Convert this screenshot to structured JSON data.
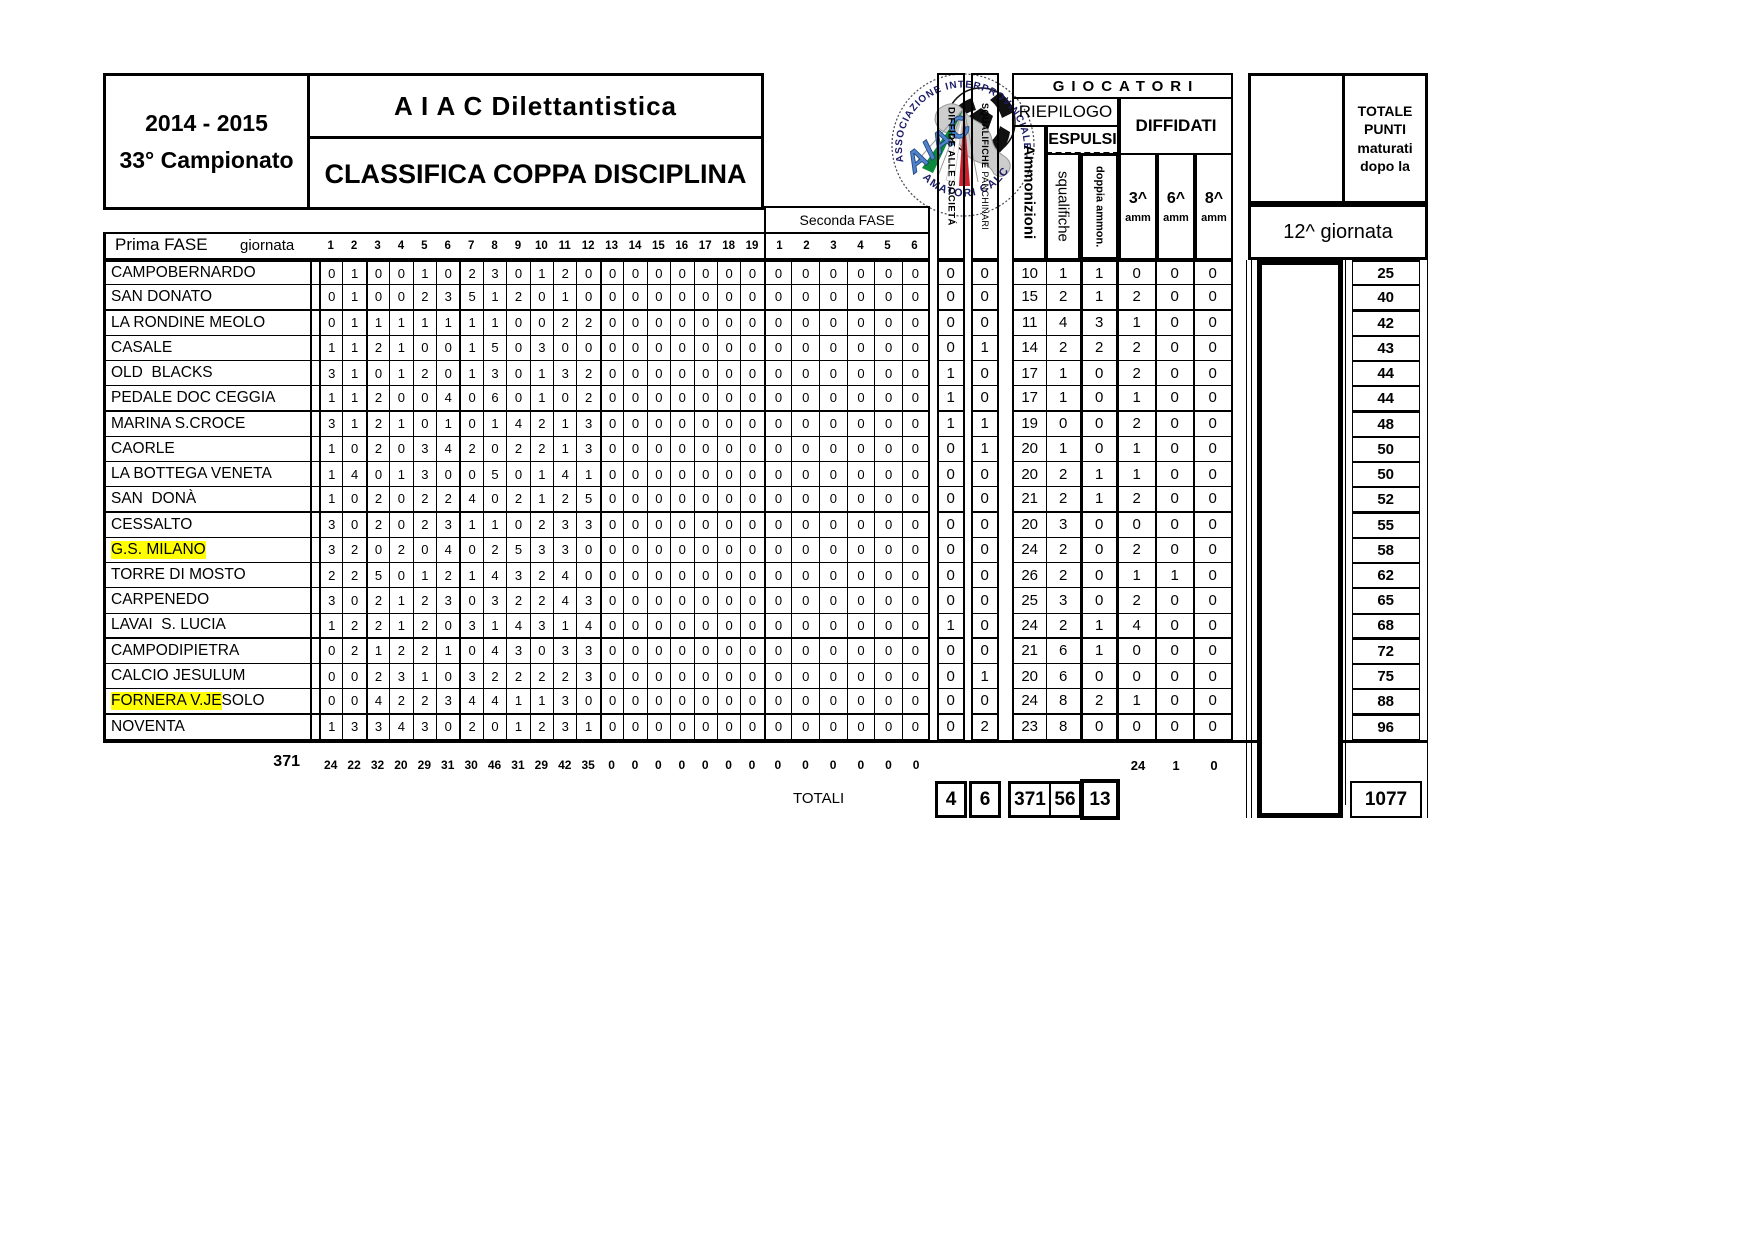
{
  "meta": {
    "season": "2014 - 2015",
    "championship": "33° Campionato",
    "org": "A I A C    Dilettantistica",
    "title": "CLASSIFICA COPPA DISCIPLINA"
  },
  "logo": {
    "arc_top": "ASSOCIAZIONE   INTERPROVINCIALE · TREVISO",
    "arc_bottom": "AMATORI CALCIO",
    "aiac": "AIAC"
  },
  "headers": {
    "prima_fase": "Prima FASE",
    "giornata": "giornata",
    "seconda_fase": "Seconda FASE",
    "prima_days": [
      "1",
      "2",
      "3",
      "4",
      "5",
      "6",
      "7",
      "8",
      "9",
      "10",
      "11",
      "12",
      "13",
      "14",
      "15",
      "16",
      "17",
      "18",
      "19"
    ],
    "seconda_days": [
      "1",
      "2",
      "3",
      "4",
      "5",
      "6"
    ],
    "diffide": "DIFFIDE ALLE SOCIETÁ",
    "squalifiche_panch_1": "SQUALIFICHE ",
    "squalifiche_panch_2": "PANCHINARI",
    "giocatori": "GIOCATORI",
    "riepilogo": "RIEPILOGO",
    "espulsi": "ESPULSI",
    "diffidati": "DIFFIDATI",
    "ammonizioni": "Ammonizioni",
    "squalifiche": "squalifiche",
    "doppia": "doppia ammon.",
    "a3": "3^",
    "a6": "6^",
    "a8": "8^",
    "amm_small": "amm",
    "totale_punti": [
      "TOTALE",
      "PUNTI",
      "maturati",
      "dopo la"
    ],
    "giornata12": "12^ giornata",
    "totali_label": "TOTALI"
  },
  "teams": [
    {
      "h": "",
      "n": "CAMPOBERNARDO",
      "p": [
        0,
        1,
        0,
        0,
        1,
        0,
        2,
        3,
        0,
        1,
        2,
        0,
        0,
        0,
        0,
        0,
        0,
        0,
        0
      ],
      "s": [
        0,
        0,
        0,
        0,
        0,
        0
      ],
      "v": [
        0,
        0,
        10,
        1,
        1,
        0,
        0,
        0
      ],
      "t": 25
    },
    {
      "h": "",
      "n": "SAN DONATO",
      "p": [
        0,
        1,
        0,
        0,
        2,
        3,
        5,
        1,
        2,
        0,
        1,
        0,
        0,
        0,
        0,
        0,
        0,
        0,
        0
      ],
      "s": [
        0,
        0,
        0,
        0,
        0,
        0
      ],
      "v": [
        0,
        0,
        15,
        2,
        1,
        2,
        0,
        0
      ],
      "t": 40
    },
    {
      "h": "",
      "n": "LA RONDINE MEOLO",
      "p": [
        0,
        1,
        1,
        1,
        1,
        1,
        1,
        1,
        0,
        0,
        2,
        2,
        0,
        0,
        0,
        0,
        0,
        0,
        0
      ],
      "s": [
        0,
        0,
        0,
        0,
        0,
        0
      ],
      "v": [
        0,
        0,
        11,
        4,
        3,
        1,
        0,
        0
      ],
      "t": 42
    },
    {
      "h": "",
      "n": "CASALE",
      "p": [
        1,
        1,
        2,
        1,
        0,
        0,
        1,
        5,
        0,
        3,
        0,
        0,
        0,
        0,
        0,
        0,
        0,
        0,
        0
      ],
      "s": [
        0,
        0,
        0,
        0,
        0,
        0
      ],
      "v": [
        0,
        1,
        14,
        2,
        2,
        2,
        0,
        0
      ],
      "t": 43
    },
    {
      "h": "",
      "n": "OLD  BLACKS",
      "p": [
        3,
        1,
        0,
        1,
        2,
        0,
        1,
        3,
        0,
        1,
        3,
        2,
        0,
        0,
        0,
        0,
        0,
        0,
        0
      ],
      "s": [
        0,
        0,
        0,
        0,
        0,
        0
      ],
      "v": [
        1,
        0,
        17,
        1,
        0,
        2,
        0,
        0
      ],
      "t": 44
    },
    {
      "h": "",
      "n": "PEDALE DOC CEGGIA",
      "p": [
        1,
        1,
        2,
        0,
        0,
        4,
        0,
        6,
        0,
        1,
        0,
        2,
        0,
        0,
        0,
        0,
        0,
        0,
        0
      ],
      "s": [
        0,
        0,
        0,
        0,
        0,
        0
      ],
      "v": [
        1,
        0,
        17,
        1,
        0,
        1,
        0,
        0
      ],
      "t": 44
    },
    {
      "h": "",
      "n": "MARINA S.CROCE",
      "p": [
        3,
        1,
        2,
        1,
        0,
        1,
        0,
        1,
        4,
        2,
        1,
        3,
        0,
        0,
        0,
        0,
        0,
        0,
        0
      ],
      "s": [
        0,
        0,
        0,
        0,
        0,
        0
      ],
      "v": [
        1,
        1,
        19,
        0,
        0,
        2,
        0,
        0
      ],
      "t": 48
    },
    {
      "h": "",
      "n": "CAORLE",
      "p": [
        1,
        0,
        2,
        0,
        3,
        4,
        2,
        0,
        2,
        2,
        1,
        3,
        0,
        0,
        0,
        0,
        0,
        0,
        0
      ],
      "s": [
        0,
        0,
        0,
        0,
        0,
        0
      ],
      "v": [
        0,
        1,
        20,
        1,
        0,
        1,
        0,
        0
      ],
      "t": 50
    },
    {
      "h": "",
      "n": "LA BOTTEGA VENETA",
      "p": [
        1,
        4,
        0,
        1,
        3,
        0,
        0,
        5,
        0,
        1,
        4,
        1,
        0,
        0,
        0,
        0,
        0,
        0,
        0
      ],
      "s": [
        0,
        0,
        0,
        0,
        0,
        0
      ],
      "v": [
        0,
        0,
        20,
        2,
        1,
        1,
        0,
        0
      ],
      "t": 50
    },
    {
      "h": "",
      "n": "SAN  DONÀ",
      "p": [
        1,
        0,
        2,
        0,
        2,
        2,
        4,
        0,
        2,
        1,
        2,
        5,
        0,
        0,
        0,
        0,
        0,
        0,
        0
      ],
      "s": [
        0,
        0,
        0,
        0,
        0,
        0
      ],
      "v": [
        0,
        0,
        21,
        2,
        1,
        2,
        0,
        0
      ],
      "t": 52
    },
    {
      "h": "",
      "n": "CESSALTO",
      "p": [
        3,
        0,
        2,
        0,
        2,
        3,
        1,
        1,
        0,
        2,
        3,
        3,
        0,
        0,
        0,
        0,
        0,
        0,
        0
      ],
      "s": [
        0,
        0,
        0,
        0,
        0,
        0
      ],
      "v": [
        0,
        0,
        20,
        3,
        0,
        0,
        0,
        0
      ],
      "t": 55
    },
    {
      "h": "G.S. MILANO",
      "n": "",
      "p": [
        3,
        2,
        0,
        2,
        0,
        4,
        0,
        2,
        5,
        3,
        3,
        0,
        0,
        0,
        0,
        0,
        0,
        0,
        0
      ],
      "s": [
        0,
        0,
        0,
        0,
        0,
        0
      ],
      "v": [
        0,
        0,
        24,
        2,
        0,
        2,
        0,
        0
      ],
      "t": 58
    },
    {
      "h": "",
      "n": "TORRE DI MOSTO",
      "p": [
        2,
        2,
        5,
        0,
        1,
        2,
        1,
        4,
        3,
        2,
        4,
        0,
        0,
        0,
        0,
        0,
        0,
        0,
        0
      ],
      "s": [
        0,
        0,
        0,
        0,
        0,
        0
      ],
      "v": [
        0,
        0,
        26,
        2,
        0,
        1,
        1,
        0
      ],
      "t": 62
    },
    {
      "h": "",
      "n": "CARPENEDO",
      "p": [
        3,
        0,
        2,
        1,
        2,
        3,
        0,
        3,
        2,
        2,
        4,
        3,
        0,
        0,
        0,
        0,
        0,
        0,
        0
      ],
      "s": [
        0,
        0,
        0,
        0,
        0,
        0
      ],
      "v": [
        0,
        0,
        25,
        3,
        0,
        2,
        0,
        0
      ],
      "t": 65
    },
    {
      "h": "",
      "n": "LAVAI  S. LUCIA",
      "p": [
        1,
        2,
        2,
        1,
        2,
        0,
        3,
        1,
        4,
        3,
        1,
        4,
        0,
        0,
        0,
        0,
        0,
        0,
        0
      ],
      "s": [
        0,
        0,
        0,
        0,
        0,
        0
      ],
      "v": [
        1,
        0,
        24,
        2,
        1,
        4,
        0,
        0
      ],
      "t": 68
    },
    {
      "h": "",
      "n": "CAMPODIPIETRA",
      "p": [
        0,
        2,
        1,
        2,
        2,
        1,
        0,
        4,
        3,
        0,
        3,
        3,
        0,
        0,
        0,
        0,
        0,
        0,
        0
      ],
      "s": [
        0,
        0,
        0,
        0,
        0,
        0
      ],
      "v": [
        0,
        0,
        21,
        6,
        1,
        0,
        0,
        0
      ],
      "t": 72
    },
    {
      "h": "",
      "n": "CALCIO JESULUM",
      "p": [
        0,
        0,
        2,
        3,
        1,
        0,
        3,
        2,
        2,
        2,
        2,
        3,
        0,
        0,
        0,
        0,
        0,
        0,
        0
      ],
      "s": [
        0,
        0,
        0,
        0,
        0,
        0
      ],
      "v": [
        0,
        1,
        20,
        6,
        0,
        0,
        0,
        0
      ],
      "t": 75
    },
    {
      "h": "FORNERA V.JE",
      "n": "SOLO",
      "p": [
        0,
        0,
        4,
        2,
        2,
        3,
        4,
        4,
        1,
        1,
        3,
        0,
        0,
        0,
        0,
        0,
        0,
        0,
        0
      ],
      "s": [
        0,
        0,
        0,
        0,
        0,
        0
      ],
      "v": [
        0,
        0,
        24,
        8,
        2,
        1,
        0,
        0
      ],
      "t": 88
    },
    {
      "h": "",
      "n": "NOVENTA",
      "p": [
        1,
        3,
        3,
        4,
        3,
        0,
        2,
        0,
        1,
        2,
        3,
        1,
        0,
        0,
        0,
        0,
        0,
        0,
        0
      ],
      "s": [
        0,
        0,
        0,
        0,
        0,
        0
      ],
      "v": [
        0,
        2,
        23,
        8,
        0,
        0,
        0,
        0
      ],
      "t": 96
    }
  ],
  "totals": {
    "left_sum": "371",
    "prima": [
      24,
      22,
      32,
      20,
      29,
      31,
      30,
      46,
      31,
      29,
      42,
      35,
      0,
      0,
      0,
      0,
      0,
      0,
      0
    ],
    "seconda": [
      0,
      0,
      0,
      0,
      0,
      0
    ],
    "diffidati": [
      24,
      1,
      0
    ],
    "boxes": {
      "diffide": "4",
      "panchinari": "6",
      "ammonizioni": "371",
      "squalifiche": "56",
      "doppia": "13"
    },
    "punti": "1077"
  },
  "colors": {
    "highlight": "#ffff00",
    "border": "#000000"
  }
}
